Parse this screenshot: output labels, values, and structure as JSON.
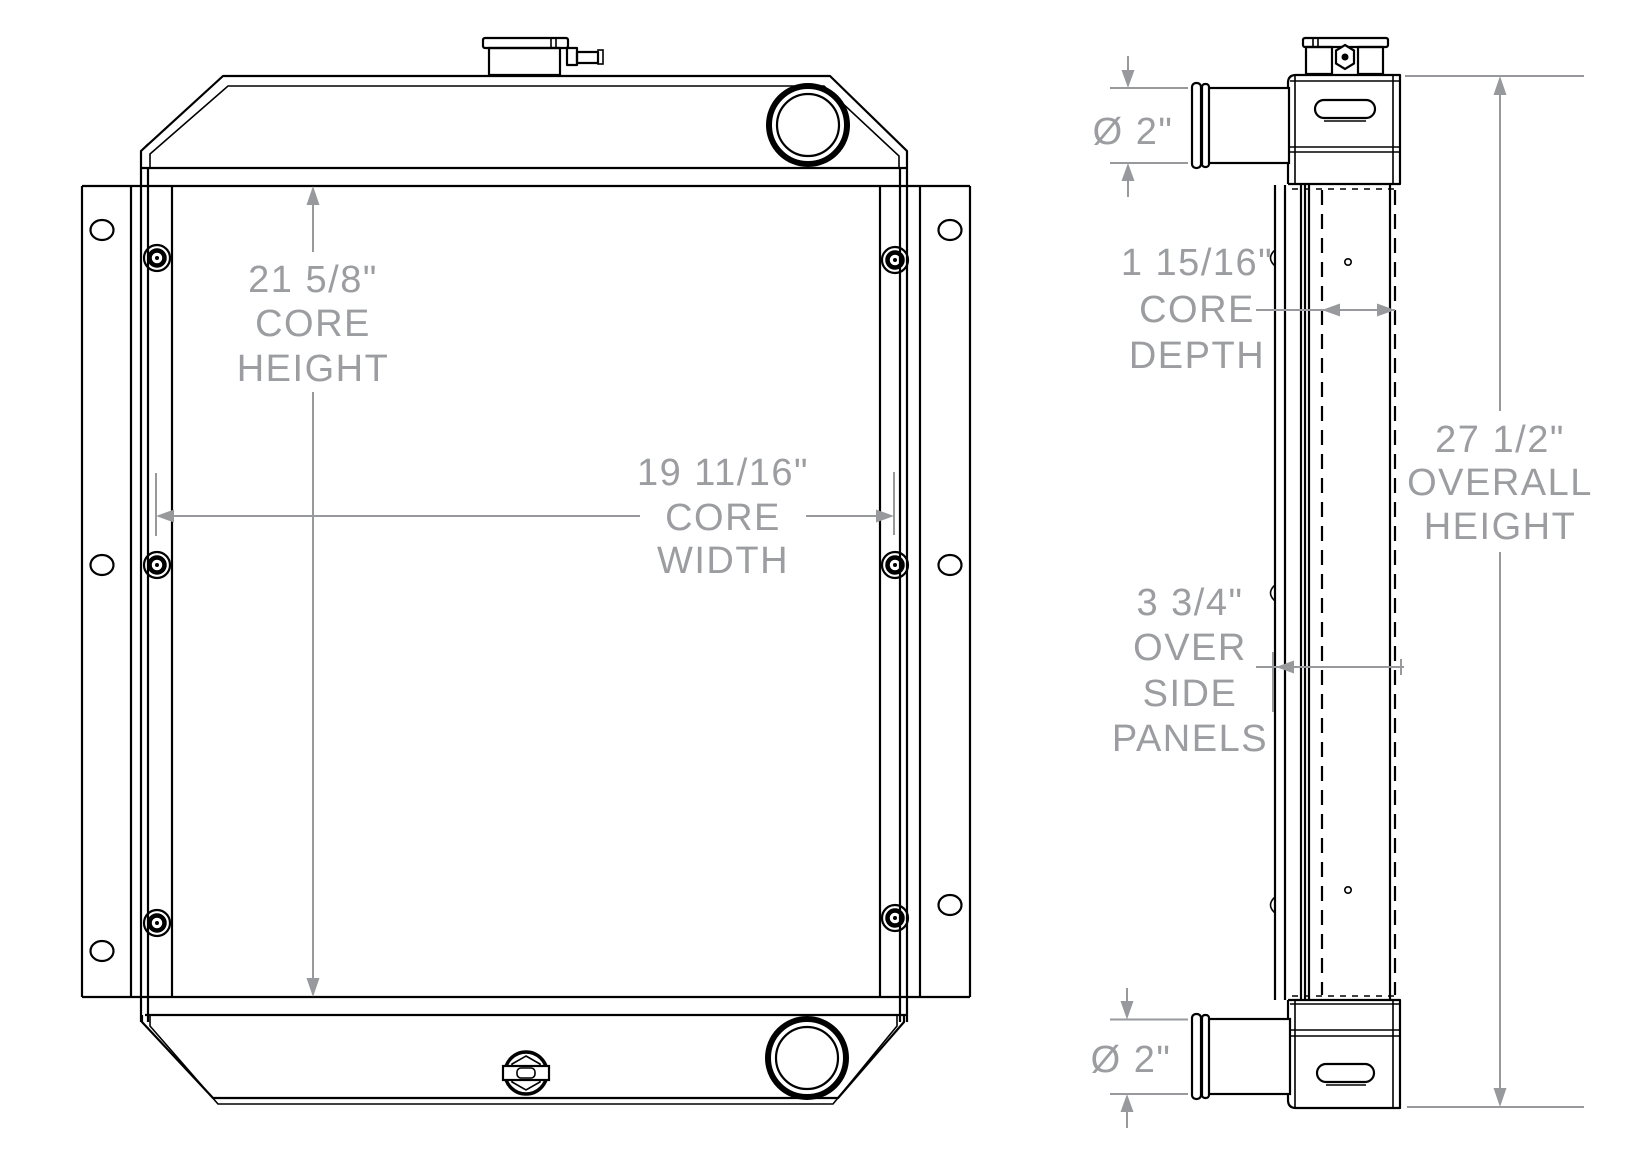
{
  "colors": {
    "line": "#000000",
    "dimension": "#97999c",
    "background": "#ffffff"
  },
  "dims": {
    "core_height": {
      "lines": [
        "21 5/8\"",
        "CORE",
        "HEIGHT"
      ]
    },
    "core_width": {
      "lines": [
        "19 11/16\"",
        "CORE",
        "WIDTH"
      ]
    },
    "top_port_diameter": {
      "lines": [
        "Ø 2\""
      ]
    },
    "core_depth": {
      "lines": [
        "1 15/16\"",
        "CORE",
        "DEPTH"
      ]
    },
    "overall_height": {
      "lines": [
        "27 1/2\"",
        "OVERALL",
        "HEIGHT"
      ]
    },
    "over_side_panels": {
      "lines": [
        "3 3/4\"",
        "OVER",
        "SIDE",
        "PANELS"
      ]
    },
    "bottom_port_diameter": {
      "lines": [
        "Ø 2\""
      ]
    }
  }
}
